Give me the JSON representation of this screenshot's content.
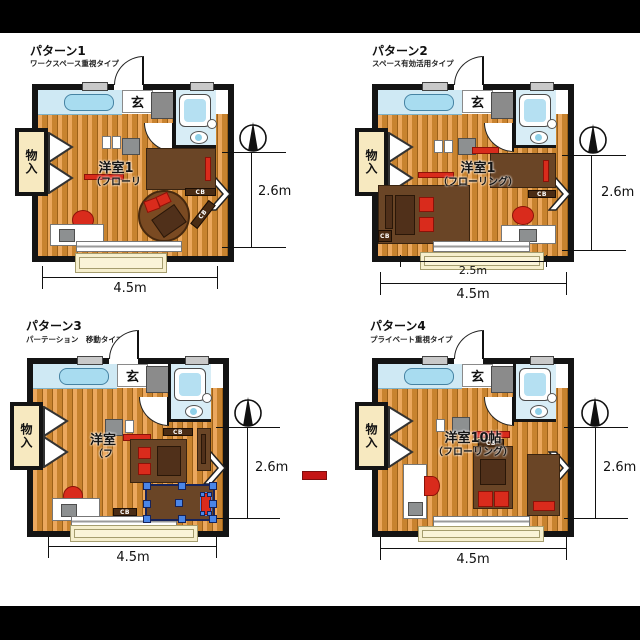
{
  "patterns": [
    {
      "title": "パターン1",
      "subtitle": "ワークスペース重視タイプ",
      "entrance": "玄",
      "closet": "物入",
      "room_line1": "洋室1",
      "room_line2": "（フローリ",
      "cb": "CB",
      "dim_height": "2.6m",
      "dim_width": "4.5m"
    },
    {
      "title": "パターン2",
      "subtitle": "スペース有効活用タイプ",
      "entrance": "玄",
      "closet": "物入",
      "room_line1": "洋室1",
      "room_line2": "（フローリング）",
      "cb": "CB",
      "dim_height": "2.6m",
      "dim_width": "4.5m",
      "dim_partial": "2.5m"
    },
    {
      "title": "パターン3",
      "subtitle": "パーテーション　移動タイプ",
      "entrance": "玄",
      "closet": "物入",
      "room_line1": "洋室",
      "room_line2": "（フ",
      "cb": "CB",
      "dim_height": "2.6m",
      "dim_width": "4.5m"
    },
    {
      "title": "パターン4",
      "subtitle": "プライベート重視タイプ",
      "entrance": "玄",
      "closet": "物入",
      "room_line1": "洋室10帖",
      "room_line2": "（フローリング）",
      "cb": "CB",
      "dim_height": "2.6m",
      "dim_width": "4.5m"
    }
  ],
  "colors": {
    "letterbox": "#000000",
    "canvas": "#ffffff",
    "wall": "#141414",
    "floor_plank": "#eca85e",
    "bath_blue": "#d8edf6",
    "closet_cream": "#f7e9c0",
    "furniture_brown": "#6a4526",
    "accent_red": "#d92b1c",
    "selection_blue": "#4a86e8"
  }
}
